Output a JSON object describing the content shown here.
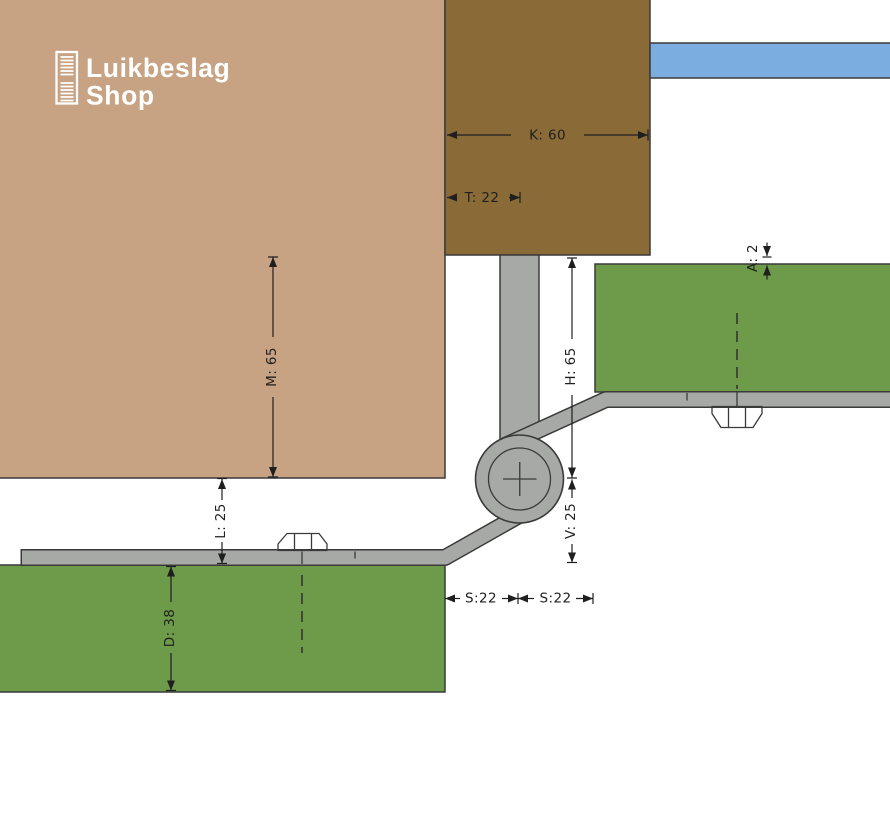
{
  "brand": {
    "name_line1": "Luikbeslag",
    "name_line2": "Shop",
    "icon": "shutter-icon"
  },
  "colors": {
    "wall_tan": "#c7a383",
    "beam_brown": "#8a6b38",
    "slat_blue": "#7cade0",
    "shutter_green": "#6d9b4a",
    "steel_gray": "#a6a9a5",
    "steel_light": "#d7d9d5",
    "outline_dark": "#3a3a3a",
    "dimension_ink": "#1f1f1f",
    "logo_white": "#ffffff",
    "background": "#ffffff"
  },
  "drawing": {
    "dimensions": {
      "K": {
        "label": "K: 60",
        "value": 60
      },
      "T": {
        "label": "T: 22",
        "value": 22
      },
      "M": {
        "label": "M: 65",
        "value": 65
      },
      "L": {
        "label": "L: 25",
        "value": 25
      },
      "D": {
        "label": "D: 38",
        "value": 38
      },
      "H": {
        "label": "H: 65",
        "value": 65
      },
      "V": {
        "label": "V: 25",
        "value": 25
      },
      "A": {
        "label": "A: 2",
        "value": 2
      },
      "S1": {
        "label": "S:22",
        "value": 22
      },
      "S2": {
        "label": "S:22",
        "value": 22
      }
    }
  }
}
